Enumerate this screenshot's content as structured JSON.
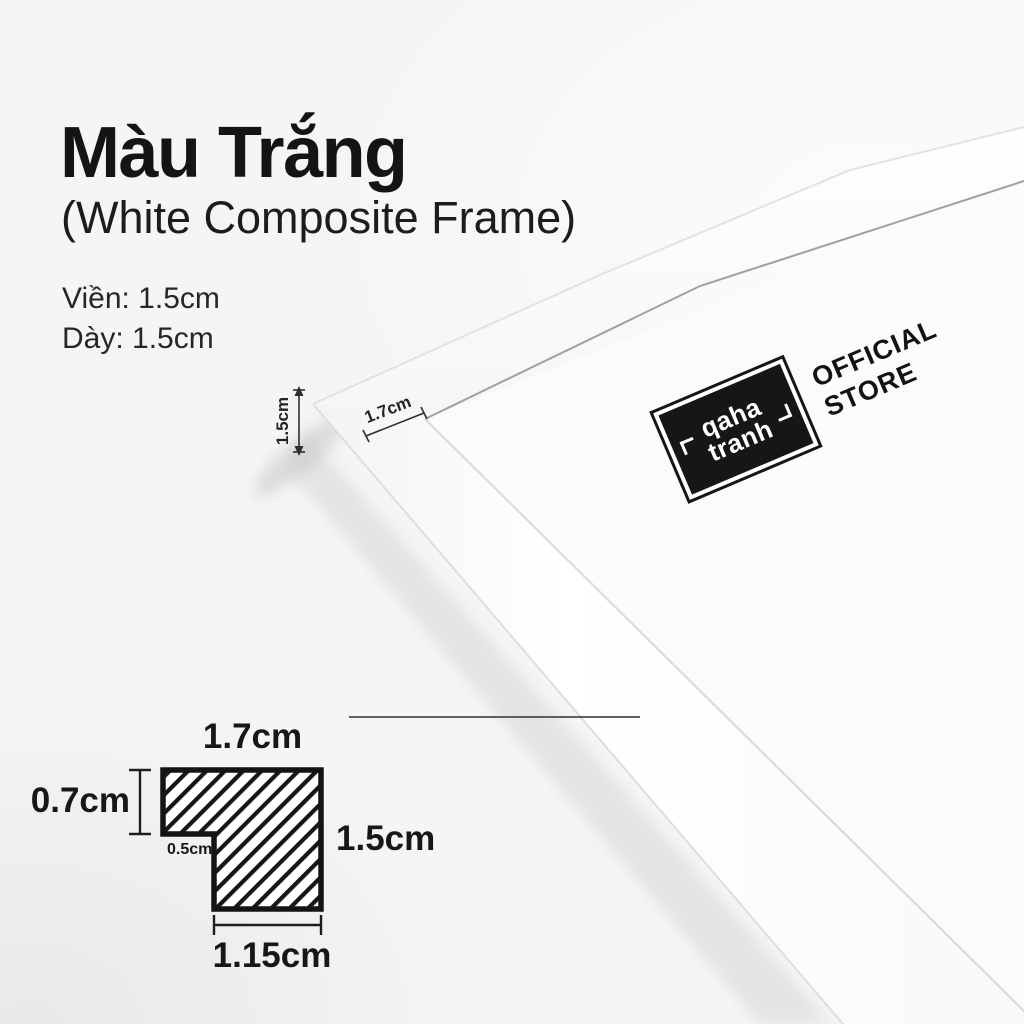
{
  "colors": {
    "background": "#f5f5f6",
    "text": "#141414",
    "frame_white": "#fdfdfe",
    "badge_black": "#161616",
    "hatch_black": "#161616"
  },
  "header": {
    "title": "Màu Trắng",
    "subtitle": "(White Composite Frame)",
    "spec_border": "Viền: 1.5cm",
    "spec_thickness": "Dày: 1.5cm"
  },
  "photo": {
    "depth_label": "1.5cm",
    "face_width_label": "1.7cm",
    "badge": {
      "name_line1": "qaha",
      "name_line2": "tranh"
    },
    "official_line1": "OFFICIAL",
    "official_line2": "STORE"
  },
  "profile_diagram": {
    "top_width": "1.7cm",
    "left_height": "0.7cm",
    "right_height": "1.5cm",
    "bottom_width": "1.15cm",
    "step_width": "0.5cm"
  }
}
